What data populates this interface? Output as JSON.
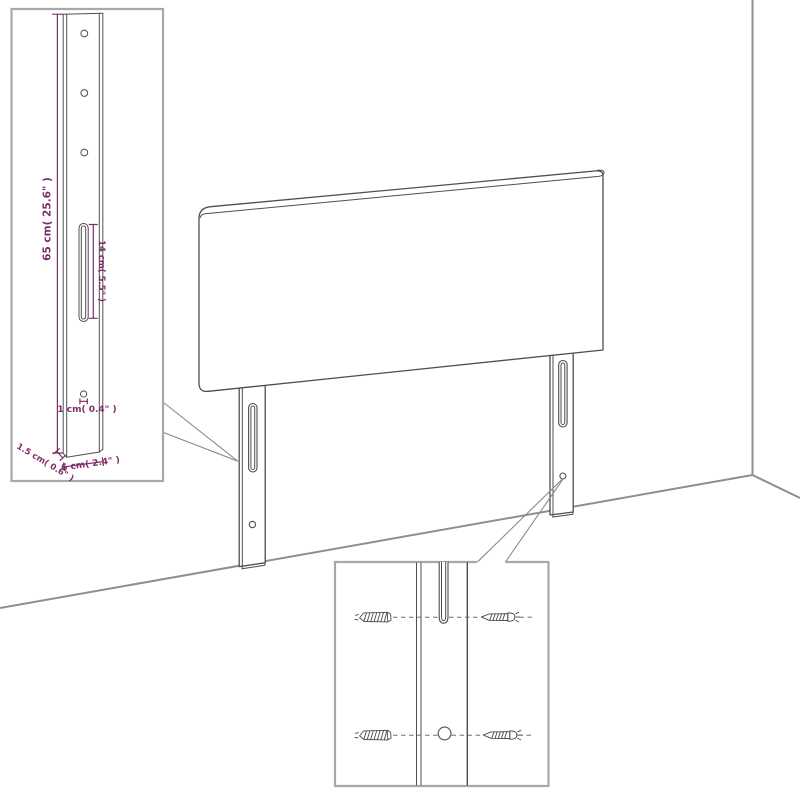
{
  "diagram": {
    "title": "headboard-mounting-dimension-diagram",
    "subject": "upholstered headboard with two mounting legs shown against a room corner, with a leg dimension inset and a wall-plug/screw detail inset",
    "colors": {
      "dimension_text": "#7d2e68",
      "furniture_outline": "#4f4f4f",
      "inset_frame": "#a8a8a8",
      "room_lines": "#8f8f8f",
      "background": "#ffffff"
    },
    "leg_detail_inset": {
      "labels": {
        "leg_height": "65 cm( 25.6\" )",
        "slot_length": "14 cm( 5.5\" )",
        "hole_width": "1 cm( 0.4\" )",
        "leg_thickness": "1.5 cm( 0.6\" )",
        "leg_width": "6 cm( 2.4\" )"
      }
    }
  }
}
